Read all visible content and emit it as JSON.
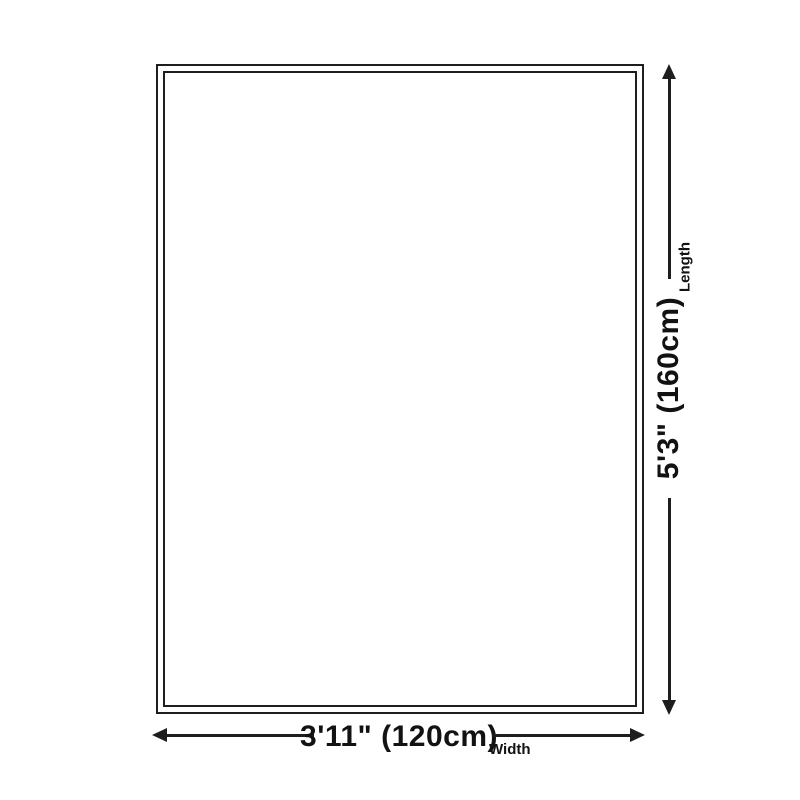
{
  "diagram": {
    "background_color": "#ffffff",
    "line_color": "#1e1e1e",
    "text_color": "#121212",
    "length": {
      "value": "5'3\" (160cm)",
      "label": "Length"
    },
    "width": {
      "value": "3'11\" (120cm)",
      "label": "Width"
    }
  }
}
